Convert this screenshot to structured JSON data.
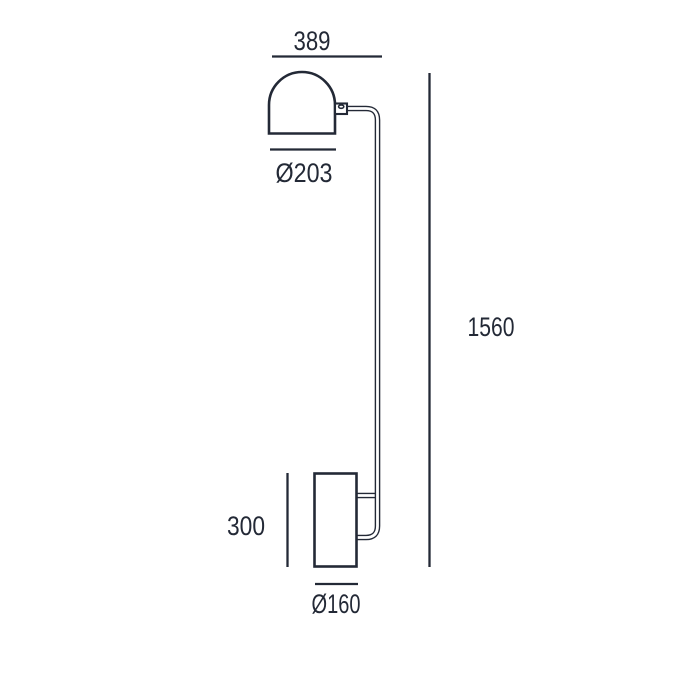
{
  "diagram": {
    "labels": {
      "top_width": "389",
      "shade_diameter": "Ø203",
      "total_height": "1560",
      "base_height": "300",
      "base_diameter": "Ø160"
    },
    "colors": {
      "line": "#232936",
      "background": "#ffffff"
    }
  }
}
